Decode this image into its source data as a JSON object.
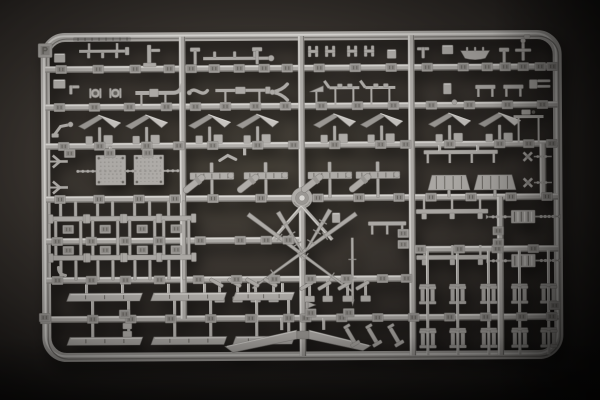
{
  "image_type": "photograph",
  "subject": "light-gray injection-molded plastic model-kit sprue (parts runner) on a dark backdrop",
  "palette": {
    "bg_center": "#474239",
    "bg_mid": "#2a2623",
    "bg_edge": "#0d0c0b",
    "plastic_base": "#b2afab",
    "plastic_light": "#dcdad6",
    "plastic_mid": "#9d9a96",
    "plastic_dark": "#7c7975",
    "plastic_deep": "#67645f",
    "tab_face": "#a7a4a0",
    "tab_inset": "#908d89",
    "shadow": "rgba(0,0,0,0.55)"
  },
  "frame": {
    "x": 46,
    "y": 36,
    "w": 512,
    "h": 320,
    "rx": 20,
    "stroke": 9,
    "tilt_deg": -0.35
  },
  "runners": {
    "h": [
      [
        46,
        558,
        68
      ],
      [
        46,
        558,
        106
      ],
      [
        46,
        558,
        145
      ],
      [
        46,
        558,
        198
      ],
      [
        46,
        302,
        240
      ],
      [
        412,
        558,
        250
      ],
      [
        46,
        412,
        279
      ],
      [
        46,
        558,
        318
      ]
    ],
    "v": [
      [
        183,
        36,
        318
      ],
      [
        302,
        36,
        356
      ],
      [
        412,
        36,
        356
      ],
      [
        500,
        198,
        356
      ],
      [
        543,
        145,
        198
      ]
    ]
  },
  "hub": {
    "x": 302,
    "y": 198
  },
  "tabs": {
    "rows": [
      {
        "y": 68,
        "xs": [
          62,
          99,
          136,
          170,
          192,
          215,
          240,
          265,
          288,
          320,
          356,
          392,
          428,
          464,
          488,
          506,
          524,
          541,
          553
        ]
      },
      {
        "y": 106,
        "xs": [
          60,
          95,
          130,
          167,
          196,
          226,
          256,
          286,
          322,
          358,
          394,
          432,
          470,
          508,
          543
        ]
      },
      {
        "y": 145,
        "xs": [
          64,
          100,
          147,
          179,
          213,
          258,
          294,
          335,
          381,
          406,
          450,
          500,
          529,
          552
        ]
      },
      {
        "y": 198,
        "xs": [
          60,
          99,
          139,
          175,
          213,
          261,
          318,
          359,
          399,
          431,
          471,
          511,
          547
        ]
      },
      {
        "y": 240,
        "xs": [
          57,
          91,
          125,
          159,
          200,
          240,
          266,
          288
        ]
      },
      {
        "y": 250,
        "xs": [
          420,
          459,
          497,
          533
        ]
      },
      {
        "y": 279,
        "xs": [
          57,
          91,
          125,
          159,
          198,
          236,
          274,
          310,
          346,
          382,
          406
        ]
      },
      {
        "y": 318,
        "xs": [
          45,
          92,
          130,
          170,
          210,
          250,
          288,
          305,
          341,
          377,
          413,
          449,
          485,
          521,
          551
        ]
      }
    ],
    "loose": [
      [
        70,
        152
      ],
      [
        110,
        152
      ],
      [
        148,
        152
      ],
      [
        68,
        228
      ],
      [
        105,
        228
      ],
      [
        142,
        228
      ],
      [
        176,
        228
      ],
      [
        68,
        249
      ],
      [
        105,
        249
      ],
      [
        142,
        249
      ],
      [
        176,
        249
      ],
      [
        403,
        234
      ],
      [
        403,
        245
      ],
      [
        498,
        232
      ],
      [
        498,
        244
      ],
      [
        124,
        313
      ],
      [
        44,
        316
      ],
      [
        554,
        307
      ],
      [
        310,
        313
      ],
      [
        348,
        313
      ]
    ]
  },
  "parts": [
    [
      "frametab",
      46,
      49
    ],
    [
      "emboss",
      74,
      38
    ],
    [
      "box",
      55,
      52,
      11,
      9
    ],
    [
      "hangrod",
      80,
      50
    ],
    [
      "bracket1",
      148,
      44
    ],
    [
      "tpost",
      196,
      50
    ],
    [
      "studrod",
      204,
      58
    ],
    [
      "tpost",
      258,
      50
    ],
    [
      "clamp",
      314,
      51
    ],
    [
      "clamp",
      331,
      51
    ],
    [
      "clamp",
      353,
      51
    ],
    [
      "clamp",
      370,
      51
    ],
    [
      "box",
      388,
      50,
      9,
      9
    ],
    [
      "tpart",
      424,
      48
    ],
    [
      "box",
      443,
      46,
      11,
      9
    ],
    [
      "boat",
      476,
      54
    ],
    [
      "tpost",
      505,
      52
    ],
    [
      "valve",
      524,
      48
    ],
    [
      "box",
      54,
      78,
      12,
      9
    ],
    [
      "lbracket",
      70,
      84
    ],
    [
      "spool",
      96,
      92
    ],
    [
      "spool",
      116,
      92
    ],
    [
      "pipe",
      136,
      92
    ],
    [
      "scurve",
      190,
      88
    ],
    [
      "longrod",
      216,
      90
    ],
    [
      "wye",
      283,
      92
    ],
    [
      "wedge",
      310,
      92
    ],
    [
      "davitrod",
      330,
      88
    ],
    [
      "davitrod",
      366,
      88
    ],
    [
      "box",
      444,
      84,
      8,
      11
    ],
    [
      "bench2",
      476,
      88
    ],
    [
      "bench2",
      504,
      88
    ],
    [
      "fork",
      536,
      84
    ],
    [
      "dot",
      455,
      103
    ],
    [
      "crank",
      63,
      127
    ],
    [
      "roof",
      100
    ],
    [
      "roof",
      147
    ],
    [
      "roof",
      210
    ],
    [
      "roof",
      258
    ],
    [
      "roof",
      335
    ],
    [
      "roof",
      382
    ],
    [
      "roof",
      450
    ],
    [
      "roof",
      500
    ],
    [
      "beampart",
      514,
      118
    ],
    [
      "yfork",
      62,
      160
    ],
    [
      "yfork",
      62,
      186
    ],
    [
      "plate",
      96,
      154
    ],
    [
      "plate",
      134,
      154
    ],
    [
      "beadrodx",
      78,
      178,
      170
    ],
    [
      "stem",
      111,
      146,
      154
    ],
    [
      "stem",
      149,
      146,
      154
    ],
    [
      "vee",
      228,
      157
    ],
    [
      "stem",
      245,
      148,
      155
    ],
    [
      "seat",
      212,
      176
    ],
    [
      "seat",
      266,
      176
    ],
    [
      "seat",
      330,
      176
    ],
    [
      "seat",
      378,
      176
    ],
    [
      "benchtop",
      424,
      153,
      74,
      4
    ],
    [
      "stem",
      440,
      146,
      152
    ],
    [
      "stem",
      478,
      146,
      152
    ],
    [
      "trap",
      428,
      176,
      42,
      15
    ],
    [
      "trap",
      474,
      176,
      42,
      15
    ],
    [
      "crosspart",
      528,
      158
    ],
    [
      "crosspart",
      528,
      184
    ],
    [
      "bogie",
      68
    ],
    [
      "bogie",
      105
    ],
    [
      "bogie",
      142
    ],
    [
      "bogie",
      176
    ],
    [
      "diag",
      302,
      206,
      272,
      240
    ],
    [
      "diag",
      302,
      206,
      332,
      240
    ],
    [
      "mast",
      248,
      214,
      352,
      292
    ],
    [
      "mast",
      356,
      214,
      252,
      288
    ],
    [
      "mast",
      278,
      212,
      302,
      252
    ],
    [
      "mast",
      330,
      210,
      306,
      250
    ],
    [
      "pole",
      352,
      238,
      300
    ],
    [
      "benchtop",
      368,
      224,
      38,
      3
    ],
    [
      "box",
      332,
      213,
      8,
      10
    ],
    [
      "railbar",
      416,
      212,
      72
    ],
    [
      "ant",
      523,
      218
    ],
    [
      "railbar",
      416,
      258,
      72
    ],
    [
      "ant",
      523,
      262
    ],
    [
      "winch",
      228,
      288,
      1
    ],
    [
      "winch",
      264,
      288,
      1
    ],
    [
      "winch",
      318,
      288,
      -1
    ],
    [
      "winch",
      356,
      288,
      -1
    ],
    [
      "panel",
      66,
      292,
      76
    ],
    [
      "panel",
      150,
      292,
      76
    ],
    [
      "panel",
      232,
      292,
      62
    ],
    [
      "panel",
      66,
      336,
      76
    ],
    [
      "panel",
      150,
      336,
      76
    ],
    [
      "panel",
      232,
      336,
      62
    ],
    [
      "stem",
      86,
      283,
      292
    ],
    [
      "stem",
      122,
      283,
      292
    ],
    [
      "stem",
      168,
      283,
      292
    ],
    [
      "stem",
      204,
      283,
      292
    ],
    [
      "stem",
      248,
      283,
      292
    ],
    [
      "stem",
      282,
      283,
      292
    ],
    [
      "stem",
      92,
      300,
      336
    ],
    [
      "stem",
      128,
      300,
      336
    ],
    [
      "stem",
      174,
      300,
      336
    ],
    [
      "stem",
      210,
      300,
      336
    ],
    [
      "stem",
      256,
      300,
      336
    ],
    [
      "stem",
      288,
      300,
      336
    ],
    [
      "boxpair",
      122,
      322
    ],
    [
      "flag",
      306,
      302
    ],
    [
      "elbowpart",
      58,
      266
    ],
    [
      "colv",
      427
    ],
    [
      "colv",
      457
    ],
    [
      "colv",
      488
    ],
    [
      "colv",
      519
    ],
    [
      "colv",
      548
    ],
    [
      "bollardrow",
      297,
      [
        427,
        457,
        488,
        519,
        548
      ]
    ],
    [
      "bollardrow",
      341,
      [
        427,
        457,
        488,
        519,
        548
      ]
    ],
    [
      "blade",
      302,
      333
    ],
    [
      "stem",
      281,
      318,
      330
    ],
    [
      "stem",
      323,
      318,
      330
    ],
    [
      "davit",
      352,
      340,
      -30
    ],
    [
      "davit",
      374,
      340,
      -30
    ],
    [
      "davit",
      396,
      340,
      -30
    ]
  ]
}
